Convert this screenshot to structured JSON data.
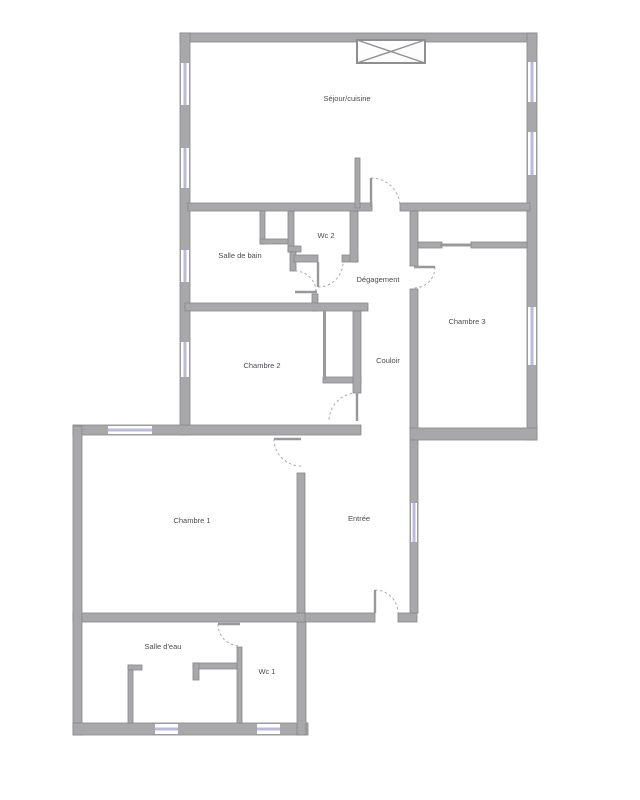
{
  "colors": {
    "wall_fill": "#a8a8ab",
    "wall_stroke": "#87878a",
    "window": "#b9badd",
    "door_swing": "#a9a9ac",
    "label_text": "#4c4c52",
    "background": "#ffffff"
  },
  "rooms": [
    {
      "name": "sejour-cuisine",
      "label": "Séjour/cuisine",
      "x": 347,
      "y": 101
    },
    {
      "name": "wc-2",
      "label": "Wc 2",
      "x": 326,
      "y": 238
    },
    {
      "name": "salle-de-bain",
      "label": "Salle de bain",
      "x": 240,
      "y": 258
    },
    {
      "name": "degagement",
      "label": "Dégagement",
      "x": 378,
      "y": 282
    },
    {
      "name": "chambre-3",
      "label": "Chambre 3",
      "x": 467,
      "y": 324
    },
    {
      "name": "chambre-2",
      "label": "Chambre 2",
      "x": 262,
      "y": 368
    },
    {
      "name": "couloir",
      "label": "Couloir",
      "x": 388,
      "y": 363
    },
    {
      "name": "chambre-1",
      "label": "Chambre 1",
      "x": 192,
      "y": 523
    },
    {
      "name": "entree",
      "label": "Entrée",
      "x": 359,
      "y": 521
    },
    {
      "name": "salle-deau",
      "label": "Salle d'eau",
      "x": 163,
      "y": 649
    },
    {
      "name": "wc-1",
      "label": "Wc 1",
      "x": 267,
      "y": 674
    }
  ],
  "plan": {
    "walls": [
      {
        "x": 180,
        "y": 33,
        "w": 357,
        "h": 9
      },
      {
        "x": 180,
        "y": 33,
        "w": 10,
        "h": 402
      },
      {
        "x": 527,
        "y": 33,
        "w": 10,
        "h": 407
      },
      {
        "x": 188,
        "y": 203,
        "w": 184,
        "h": 8
      },
      {
        "x": 400,
        "y": 203,
        "w": 130,
        "h": 8
      },
      {
        "x": 355,
        "y": 158,
        "w": 5,
        "h": 50
      },
      {
        "x": 260,
        "y": 211,
        "w": 5,
        "h": 33
      },
      {
        "x": 260,
        "y": 239,
        "w": 31,
        "h": 5
      },
      {
        "x": 288,
        "y": 211,
        "w": 6,
        "h": 41
      },
      {
        "x": 288,
        "y": 246,
        "w": 13,
        "h": 6
      },
      {
        "x": 290,
        "y": 252,
        "w": 6,
        "h": 19
      },
      {
        "x": 294,
        "y": 255,
        "w": 24,
        "h": 7
      },
      {
        "x": 342,
        "y": 255,
        "w": 16,
        "h": 7
      },
      {
        "x": 350,
        "y": 211,
        "w": 8,
        "h": 51
      },
      {
        "x": 312,
        "y": 294,
        "w": 6,
        "h": 17
      },
      {
        "x": 185,
        "y": 303,
        "w": 183,
        "h": 8
      },
      {
        "x": 323,
        "y": 377,
        "w": 38,
        "h": 6
      },
      {
        "x": 353,
        "y": 311,
        "w": 8,
        "h": 82
      },
      {
        "x": 73,
        "y": 425,
        "w": 288,
        "h": 10
      },
      {
        "x": 297,
        "y": 473,
        "w": 8,
        "h": 140
      },
      {
        "x": 410,
        "y": 211,
        "w": 8,
        "h": 55
      },
      {
        "x": 410,
        "y": 289,
        "w": 8,
        "h": 143
      },
      {
        "x": 418,
        "y": 242,
        "w": 24,
        "h": 6
      },
      {
        "x": 471,
        "y": 242,
        "w": 56,
        "h": 6
      },
      {
        "x": 410,
        "y": 428,
        "w": 127,
        "h": 12
      },
      {
        "x": 410,
        "y": 440,
        "w": 8,
        "h": 173
      },
      {
        "x": 305,
        "y": 613,
        "w": 70,
        "h": 9
      },
      {
        "x": 398,
        "y": 613,
        "w": 19,
        "h": 9
      },
      {
        "x": 73,
        "y": 613,
        "w": 232,
        "h": 9
      },
      {
        "x": 73,
        "y": 426,
        "w": 9,
        "h": 309
      },
      {
        "x": 73,
        "y": 723,
        "w": 235,
        "h": 12
      },
      {
        "x": 297,
        "y": 622,
        "w": 9,
        "h": 113
      },
      {
        "x": 237,
        "y": 647,
        "w": 5,
        "h": 76
      },
      {
        "x": 193,
        "y": 663,
        "w": 44,
        "h": 6
      },
      {
        "x": 193,
        "y": 663,
        "w": 6,
        "h": 17
      },
      {
        "x": 128,
        "y": 665,
        "w": 5,
        "h": 58
      },
      {
        "x": 128,
        "y": 665,
        "w": 14,
        "h": 5
      }
    ],
    "thin_walls": [
      {
        "x": 440,
        "y": 243.5,
        "w": 31,
        "h": 3
      },
      {
        "x": 323,
        "y": 311,
        "w": 3,
        "h": 69
      }
    ],
    "windows": [
      {
        "x": 181,
        "y": 63,
        "w": 8,
        "h": 42
      },
      {
        "x": 181,
        "y": 148,
        "w": 8,
        "h": 40
      },
      {
        "x": 181,
        "y": 250,
        "w": 8,
        "h": 32
      },
      {
        "x": 181,
        "y": 342,
        "w": 8,
        "h": 35
      },
      {
        "x": 528,
        "y": 62,
        "w": 8,
        "h": 40
      },
      {
        "x": 528,
        "y": 132,
        "w": 8,
        "h": 43
      },
      {
        "x": 528,
        "y": 307,
        "w": 8,
        "h": 58
      },
      {
        "x": 108,
        "y": 426,
        "w": 44,
        "h": 8
      },
      {
        "x": 411,
        "y": 503,
        "w": 6,
        "h": 39
      },
      {
        "x": 155,
        "y": 724,
        "w": 23,
        "h": 10
      },
      {
        "x": 257,
        "y": 724,
        "w": 23,
        "h": 10
      }
    ],
    "doors": [
      {
        "name": "sejour-door",
        "leaf": [
          371,
          178,
          371,
          207
        ],
        "arc": "M 371 178 A 29 29 0 0 1 400 207"
      },
      {
        "name": "wc2-door",
        "leaf": [
          318,
          262,
          318,
          287
        ],
        "arc": "M 318 287 A 25 25 0 0 0 343 262"
      },
      {
        "name": "bain-door",
        "leaf": [
          295,
          292,
          317,
          292
        ],
        "arc": "M 295 271 A 21 21 0 0 1 316 292"
      },
      {
        "name": "chambre3-door",
        "leaf": [
          414,
          267,
          435,
          267
        ],
        "arc": "M 435 267 A 21 21 0 0 1 414 288"
      },
      {
        "name": "chambre2-door",
        "leaf": [
          357,
          393,
          357,
          421
        ],
        "arc": "M 357 393 A 28 28 0 0 0 329 421"
      },
      {
        "name": "chambre1-door",
        "leaf": [
          274,
          439,
          301,
          439
        ],
        "arc": "M 274 439 A 27 27 0 0 0 301 466"
      },
      {
        "name": "entree-door",
        "leaf": [
          375,
          590,
          375,
          613
        ],
        "arc": "M 375 590 A 23 23 0 0 1 398 613"
      },
      {
        "name": "wc1-door",
        "leaf": [
          218,
          624,
          240,
          624
        ],
        "arc": "M 218 624 A 22 22 0 0 0 240 646"
      }
    ],
    "shaft": {
      "x": 357,
      "y": 40,
      "w": 68,
      "h": 23
    }
  }
}
